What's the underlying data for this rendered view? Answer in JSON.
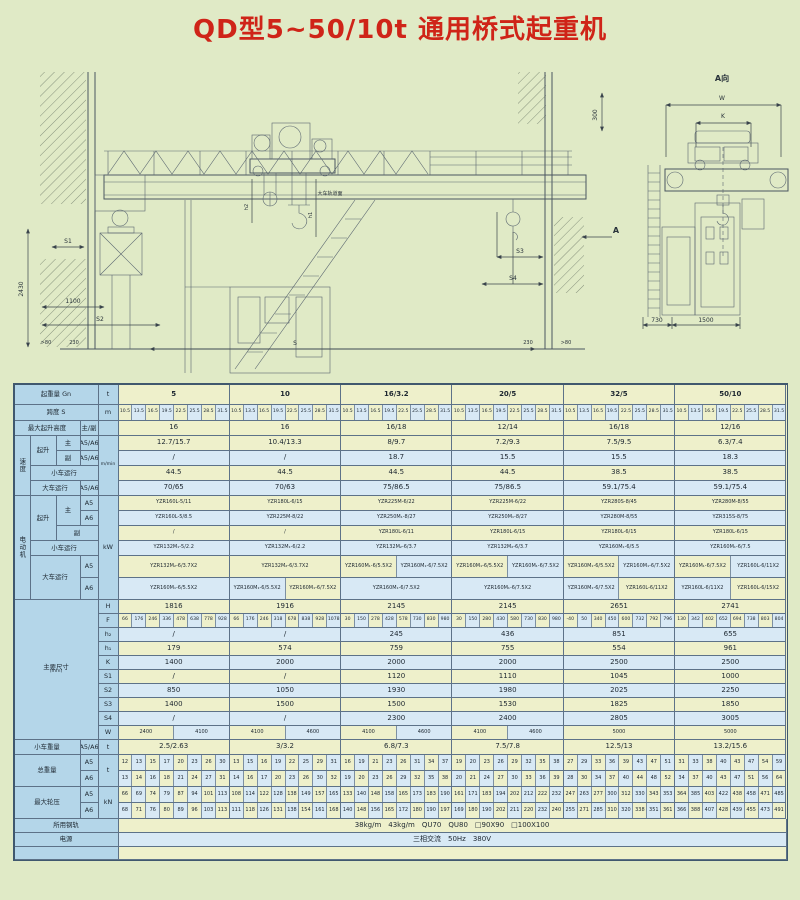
{
  "title": "QD型5~50/10t 通用桥式起重机",
  "dwg": {
    "main": {
      "d2430": "2430",
      "s1": "S1",
      "d1100": "1100",
      "s2": "S2",
      "gt80l": ">80",
      "d230l": "230",
      "s": "S",
      "d230r": "230",
      "gt80r": ">80",
      "s3": "S3",
      "s4": "S4",
      "a": "A",
      "d300": "300",
      "h1": "h1",
      "h2": "h2",
      "rail": "大车轨道面"
    },
    "end": {
      "t": "A向",
      "w": "W",
      "k": "K",
      "d730": "730",
      "d1500": "1500"
    }
  },
  "t": {
    "cap": {
      "l": "起重量 Gn",
      "u": "t",
      "v": [
        "5",
        "10",
        "16/3.2",
        "20/5",
        "32/5",
        "50/10"
      ]
    },
    "span": {
      "l": "跨度 S",
      "u": "m",
      "sp": [
        "10.5",
        "13.5",
        "16.5",
        "19.5",
        "22.5",
        "25.5",
        "28.5",
        "31.5"
      ]
    },
    "hgt": {
      "l": "最大起升高度",
      "s": "主/副",
      "v": [
        "16",
        "16",
        "16/18",
        "12/14",
        "16/18",
        "12/16"
      ]
    },
    "spd": {
      "g": "速度",
      "u": "m/min",
      "r0": {
        "a": "起升",
        "b": "主",
        "c": "A5/A6",
        "v": [
          "12.7/15.7",
          "10.4/13.3",
          "8/9.7",
          "7.2/9.3",
          "7.5/9.5",
          "6.3/7.4"
        ]
      },
      "r1": {
        "b": "副",
        "c": "A5/A6",
        "v": [
          "/",
          "/",
          "18.7",
          "15.5",
          "15.5",
          "18.3"
        ]
      },
      "r2": {
        "b": "小车运行",
        "v": [
          "44.5",
          "44.5",
          "44.5",
          "44.5",
          "38.5",
          "38.5"
        ]
      },
      "r3": {
        "b": "大车运行",
        "c": "A5/A6",
        "v": [
          "70/65",
          "70/63",
          "75/86.5",
          "75/86.5",
          "59.1/75.4",
          "59.1/75.4"
        ]
      }
    },
    "mot": {
      "g": "电动机",
      "u": "kW",
      "r0": {
        "a": "起升",
        "b": "主",
        "c": "A5",
        "v": [
          "YZR160L-5/11",
          "YZR180L-6/15",
          "YZR225M-6/22",
          "YZR225M-6/22",
          "YZR280S-8/45",
          "YZR280M-8/55"
        ]
      },
      "r1": {
        "c": "A6",
        "v": [
          "YZR160L-5/8.5",
          "YZR225M-8/22",
          "YZR250M₁-8/27",
          "YZR250M₁-8/27",
          "YZR280M-8/55",
          "YZR315S-8/75"
        ]
      },
      "r2": {
        "b": "副",
        "v": [
          "/",
          "/",
          "YZR180L-6/11",
          "YZR180L-6/15",
          "YZR180L-6/15",
          "YZR180L-6/15"
        ]
      },
      "r3": {
        "b": "小车运行",
        "v": [
          "YZR132M₁-5/2.2",
          "YZR132M₁-6/2.2",
          "YZR132M₂-6/3.7",
          "YZR132M₂-6/3.7",
          "YZR160M₁-6/5.5",
          "YZR160M₁-6/7.5"
        ]
      },
      "r4": {
        "b": "大车运行",
        "c": "A5",
        "v": [
          "YZR132M₂-6/3.7X2",
          "YZR132M₂-6/3.7X2",
          [
            "YZR160M₁-6/5.5X2",
            "YZR160M₁-6/7.5X2"
          ],
          [
            "YZR160M₁-6/5.5X2",
            "YZR160M₁-6/7.5X2"
          ],
          [
            "YZR160M₁-6/5.5X2",
            "YZR160M₁-6/7.5X2"
          ],
          [
            "YZR160M₁-6/7.5X2",
            "YZR160L-6/11X2"
          ]
        ]
      },
      "r5": {
        "c": "A6",
        "v": [
          "YZR160M₁-6/5.5X2",
          [
            "YZR160M₁-6/5.5X2",
            "YZR160M₁-6/7.5X2"
          ],
          "YZR160M₁-6/7.5X2",
          "YZR160M₁-6/7.5X2",
          [
            "YZR160M₁-6/7.5X2",
            "YZR160L-6/11X2"
          ],
          [
            "YZR160L-6/11X2",
            "YZR160L-6/15X2"
          ]
        ]
      }
    },
    "dim": {
      "g": "主要尺寸",
      "gu": "(mm)",
      "rows": [
        {
          "n": "H",
          "v": [
            "1816",
            "1916",
            "2145",
            "2145",
            "2651",
            "2741"
          ]
        },
        {
          "n": "F",
          "v": [
            [
              "66",
              "176",
              "246",
              "336",
              "478",
              "638",
              "778",
              "928"
            ],
            [
              "66",
              "176",
              "246",
              "318",
              "678",
              "838",
              "928",
              "1078"
            ],
            [
              "30",
              "150",
              "278",
              "428",
              "578",
              "730",
              "830",
              "980"
            ],
            [
              "30",
              "150",
              "280",
              "430",
              "580",
              "730",
              "830",
              "980"
            ],
            [
              "-40",
              "50",
              "340",
              "450",
              "600",
              "732",
              "792",
              "796"
            ],
            [
              "130",
              "342",
              "402",
              "652",
              "694",
              "738",
              "803",
              "804"
            ]
          ]
        },
        {
          "n": "h₂",
          "v": [
            "/",
            "/",
            "245",
            "436",
            "851",
            "655"
          ]
        },
        {
          "n": "h₁",
          "v": [
            "179",
            "574",
            "759",
            "755",
            "554",
            "961"
          ]
        },
        {
          "n": "K",
          "v": [
            "1400",
            "2000",
            "2000",
            "2000",
            "2500",
            "2500"
          ]
        },
        {
          "n": "S1",
          "v": [
            "/",
            "/",
            "1120",
            "1110",
            "1045",
            "1000"
          ]
        },
        {
          "n": "S2",
          "v": [
            "850",
            "1050",
            "1930",
            "1980",
            "2025",
            "2250"
          ]
        },
        {
          "n": "S3",
          "v": [
            "1400",
            "1500",
            "1500",
            "1530",
            "1825",
            "1850"
          ]
        },
        {
          "n": "S4",
          "v": [
            "/",
            "/",
            "2300",
            "2400",
            "2805",
            "3005"
          ]
        },
        {
          "n": "W",
          "v": [
            [
              "2400",
              "4100"
            ],
            [
              "4100",
              "4600"
            ],
            [
              "4100",
              "4600"
            ],
            [
              "4100",
              "4600"
            ],
            "5000",
            "5000"
          ]
        }
      ]
    },
    "tw": {
      "l": "小车重量",
      "d": "A5/A6",
      "u": "t",
      "v": [
        "2.5/2.63",
        "3/3.2",
        "6.8/7.3",
        "7.5/7.8",
        "12.5/13",
        "13.2/15.6"
      ]
    },
    "gw": {
      "l": "总重量",
      "u": "t",
      "r0": {
        "d": "A5",
        "v": [
          [
            12,
            13,
            15,
            17,
            20,
            23,
            26,
            30
          ],
          [
            13,
            15,
            16,
            19,
            22,
            25,
            29,
            31
          ],
          [
            16,
            19,
            21,
            23,
            26,
            31,
            34,
            37
          ],
          [
            19,
            20,
            23,
            26,
            29,
            32,
            35,
            38
          ],
          [
            27,
            29,
            33,
            36,
            39,
            43,
            47,
            51
          ],
          [
            31,
            33,
            38,
            40,
            43,
            47,
            54,
            59
          ]
        ]
      },
      "r1": {
        "d": "A6",
        "v": [
          [
            13,
            14,
            16,
            18,
            21,
            24,
            27,
            31
          ],
          [
            14,
            16,
            17,
            20,
            23,
            26,
            30,
            32
          ],
          [
            19,
            20,
            23,
            26,
            29,
            32,
            35,
            38
          ],
          [
            20,
            21,
            24,
            27,
            30,
            33,
            36,
            39
          ],
          [
            28,
            30,
            34,
            37,
            40,
            44,
            48,
            52
          ],
          [
            34,
            37,
            40,
            43,
            47,
            51,
            56,
            64
          ]
        ]
      }
    },
    "wl": {
      "l": "最大轮压",
      "u": "kN",
      "r0": {
        "d": "A5",
        "v": [
          [
            66,
            69,
            74,
            79,
            87,
            94,
            101,
            113
          ],
          [
            108,
            114,
            122,
            128,
            138,
            149,
            157,
            165
          ],
          [
            133,
            140,
            148,
            158,
            165,
            173,
            183,
            190
          ],
          [
            161,
            171,
            183,
            194,
            202,
            212,
            222,
            232
          ],
          [
            247,
            263,
            277,
            300,
            312,
            330,
            343,
            353
          ],
          [
            364,
            385,
            403,
            422,
            438,
            458,
            471,
            485
          ]
        ]
      },
      "r1": {
        "d": "A6",
        "v": [
          [
            68,
            71,
            76,
            80,
            89,
            96,
            103,
            113
          ],
          [
            111,
            118,
            126,
            131,
            138,
            154,
            161,
            168
          ],
          [
            140,
            148,
            156,
            165,
            172,
            180,
            190,
            197
          ],
          [
            169,
            180,
            190,
            202,
            211,
            220,
            232,
            240
          ],
          [
            255,
            271,
            285,
            310,
            320,
            338,
            351,
            361
          ],
          [
            366,
            388,
            407,
            428,
            439,
            455,
            473,
            491
          ]
        ]
      }
    },
    "rail": {
      "l": "所用钢轨",
      "v": "38kg/m　43kg/m　QU70　QU80　□90X90　□100X100"
    },
    "pwr": {
      "l": "电源",
      "v": "三相交流　50Hz　380V"
    }
  }
}
